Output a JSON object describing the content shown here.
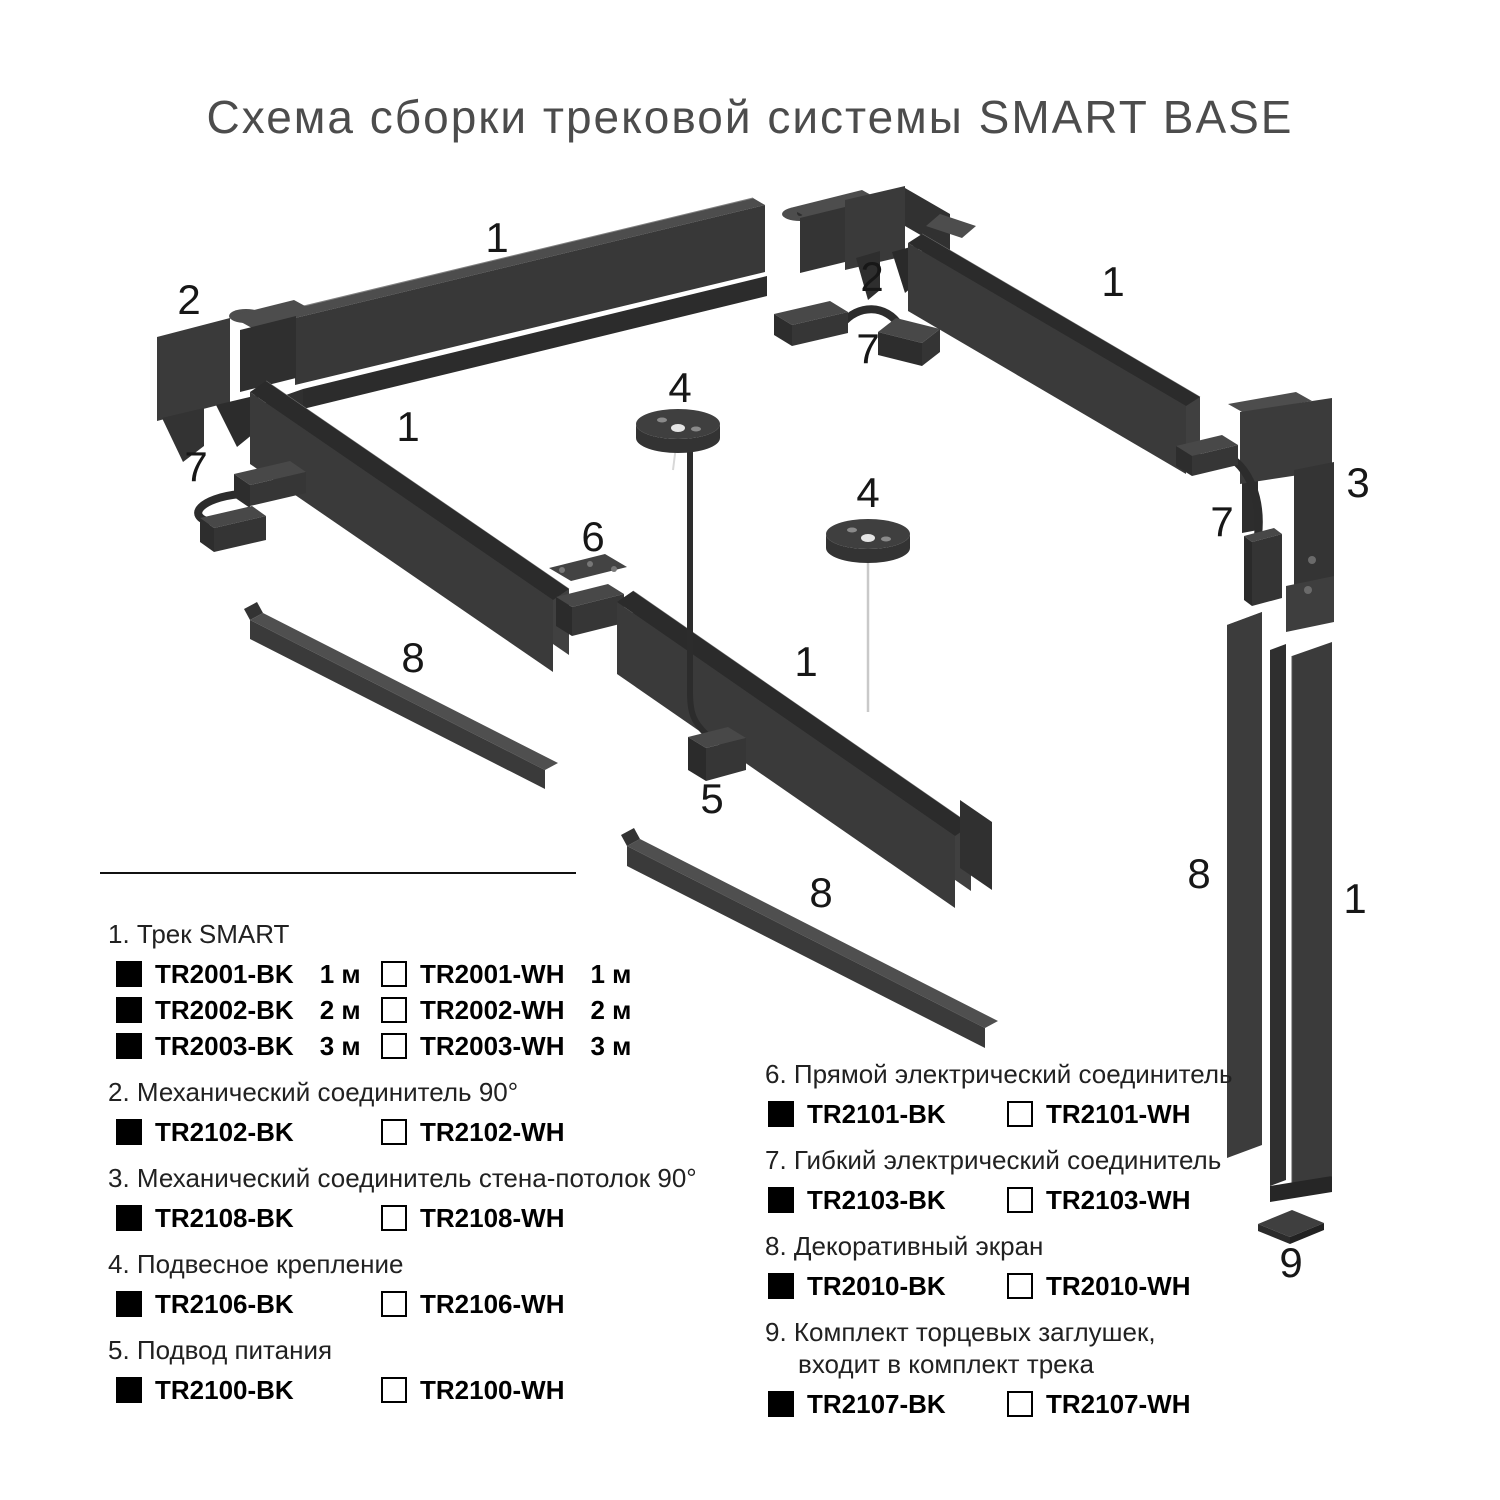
{
  "title": "Схема сборки трековой системы SMART BASE",
  "diagram": {
    "labels": [
      "1",
      "2",
      "1",
      "7",
      "8",
      "2",
      "7",
      "1",
      "4",
      "4",
      "6",
      "3",
      "7",
      "1",
      "5",
      "8",
      "8",
      "1",
      "9"
    ]
  },
  "legend": {
    "items": [
      {
        "title": "1. Трек SMART",
        "rows": [
          {
            "bk": "TR2001-BK",
            "bk_len": "1 м",
            "wh": "TR2001-WH",
            "wh_len": "1 м"
          },
          {
            "bk": "TR2002-BK",
            "bk_len": "2 м",
            "wh": "TR2002-WH",
            "wh_len": "2 м"
          },
          {
            "bk": "TR2003-BK",
            "bk_len": "3 м",
            "wh": "TR2003-WH",
            "wh_len": "3 м"
          }
        ]
      },
      {
        "title": "2. Механический соединитель 90°",
        "rows": [
          {
            "bk": "TR2102-BK",
            "wh": "TR2102-WH"
          }
        ]
      },
      {
        "title": "3. Механический соединитель стена-потолок 90°",
        "rows": [
          {
            "bk": "TR2108-BK",
            "wh": "TR2108-WH"
          }
        ]
      },
      {
        "title": "4. Подвесное крепление",
        "rows": [
          {
            "bk": "TR2106-BK",
            "wh": "TR2106-WH"
          }
        ]
      },
      {
        "title": "5. Подвод питания",
        "rows": [
          {
            "bk": "TR2100-BK",
            "wh": "TR2100-WH"
          }
        ]
      },
      {
        "title": "6. Прямой электрический соединитель",
        "rows": [
          {
            "bk": "TR2101-BK",
            "wh": "TR2101-WH"
          }
        ]
      },
      {
        "title": "7. Гибкий электрический соединитель",
        "rows": [
          {
            "bk": "TR2103-BK",
            "wh": "TR2103-WH"
          }
        ]
      },
      {
        "title": "8. Декоративный экран",
        "rows": [
          {
            "bk": "TR2010-BK",
            "wh": "TR2010-WH"
          }
        ]
      },
      {
        "title": "9. Комплект торцевых заглушек,",
        "title2": "входит в комплект трека",
        "rows": [
          {
            "bk": "TR2107-BK",
            "wh": "TR2107-WH"
          }
        ]
      }
    ]
  },
  "colors": {
    "part_dark": "#383838",
    "part_light": "#4d4d4d",
    "ink": "#171717"
  }
}
